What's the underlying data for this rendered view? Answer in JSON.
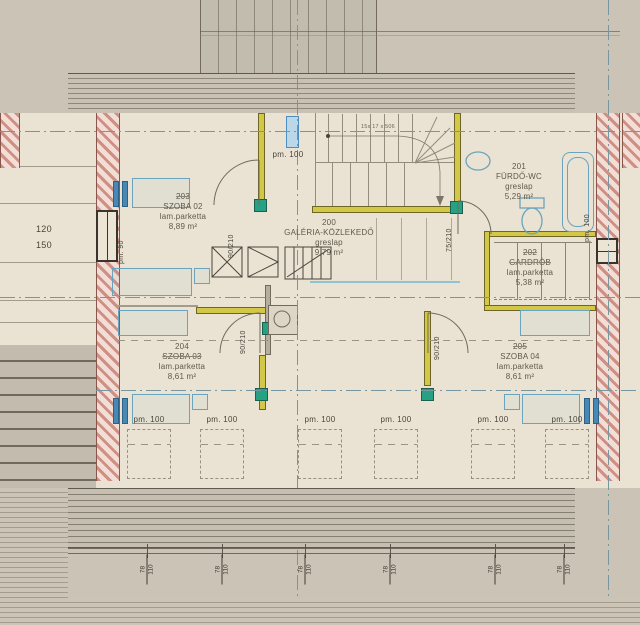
{
  "drawing": {
    "rooms": [
      {
        "num": "203",
        "name": "SZOBA 02",
        "floor": "lam.parketta",
        "area": "8,89 m²"
      },
      {
        "num": "200",
        "name": "GALÉRIA-KÖZLEKEDŐ",
        "floor": "greslap",
        "area": "9,79 m²"
      },
      {
        "num": "201",
        "name": "FÜRDŐ-WC",
        "floor": "greslap",
        "area": "5,29 m²"
      },
      {
        "num": "202",
        "name": "GARDRÓB",
        "floor": "lam.parketta",
        "area": "5,38 m²"
      },
      {
        "num": "204",
        "name": "SZOBA 03",
        "floor": "lam.parketta",
        "area": "8,61 m²"
      },
      {
        "num": "205",
        "name": "SZOBA 04",
        "floor": "lam.parketta",
        "area": "8,61 m²"
      }
    ],
    "stair_note": "15x 17 x 506",
    "labels": {
      "pm100": "pm. 100",
      "pm90": "pm. 90",
      "win_w": "120",
      "win_h": "150",
      "door90": "90/210",
      "door75": "75/210",
      "dim78": "78",
      "dim110": "110"
    }
  }
}
